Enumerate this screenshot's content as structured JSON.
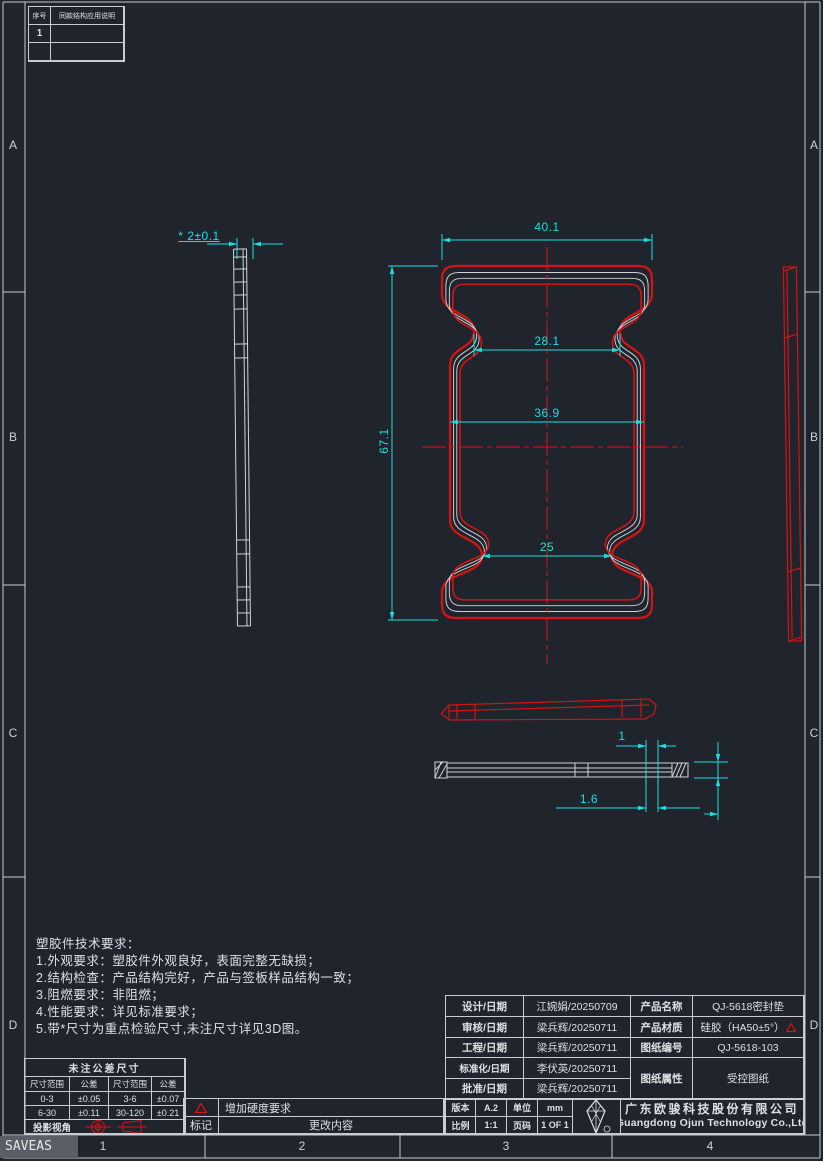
{
  "colors": {
    "bg": "#20242c",
    "frame": "#c9ccd1",
    "line": "#d8dbde",
    "text": "#dde0e3",
    "dim": "#1adfdf",
    "red": "#d31414",
    "status-bg": "#5a5f67",
    "status-text": "#e6e8ea"
  },
  "app_table": {
    "col1": "序号",
    "col2": "同款结构应用说明",
    "row1": "1"
  },
  "dims": {
    "thickness": "* 2±0.1",
    "width_top": "40.1",
    "neck_top": "28.1",
    "width_mid": "36.9",
    "height": "67.1",
    "neck_bottom": "25",
    "lip": "1",
    "lip_depth": "1.6"
  },
  "notes": {
    "title": "塑胶件技术要求：",
    "items": [
      "1.外观要求：塑胶件外观良好，表面完整无缺损；",
      "2.结构检查：产品结构完好，产品与签板样品结构一致；",
      "3.阻燃要求：非阻燃；",
      "4.性能要求：详见标准要求；",
      "5.带*尺寸为重点检验尺寸,未注尺寸详见3D图。"
    ]
  },
  "tolerance": {
    "title": "未注公差尺寸",
    "headers": [
      "尺寸范围",
      "公差",
      "尺寸范围",
      "公差"
    ],
    "rows": [
      [
        "0-3",
        "±0.05",
        "3-6",
        "±0.07"
      ],
      [
        "6-30",
        "±0.11",
        "30-120",
        "±0.21"
      ]
    ],
    "projection_label": "投影视角"
  },
  "revision": {
    "change_text": "增加硬度要求",
    "mark_label": "标记",
    "content_label": "更改内容"
  },
  "title_block": {
    "approvals": [
      {
        "label": "设计/日期",
        "value": "江婉娟/20250709"
      },
      {
        "label": "审核/日期",
        "value": "梁兵辉/20250711"
      },
      {
        "label": "工程/日期",
        "value": "梁兵辉/20250711"
      },
      {
        "label": "标准化/日期",
        "value": "李伏英/20250711"
      },
      {
        "label": "批准/日期",
        "value": "梁兵辉/20250711"
      }
    ],
    "product_name_label": "产品名称",
    "product_name": "QJ-5618密封垫",
    "material_label": "产品材质",
    "material": "硅胶（HA50±5°）",
    "drawing_no_label": "图纸编号",
    "drawing_no": "QJ-5618-103",
    "attr_label": "图纸属性",
    "attr": "受控图纸",
    "version_label": "版本",
    "version": "A.2",
    "unit_label": "单位",
    "unit": "mm",
    "scale_label": "比例",
    "scale": "1:1",
    "page_label": "页码",
    "page": "1 OF 1",
    "company_cn": "广东欧骏科技股份有限公司",
    "company_en": "Guangdong Ojun Technology Co.,Ltd"
  },
  "border": {
    "rows": [
      "A",
      "B",
      "C",
      "D"
    ],
    "cols": [
      "1",
      "2",
      "3",
      "4"
    ]
  },
  "status_text": "SAVEAS"
}
